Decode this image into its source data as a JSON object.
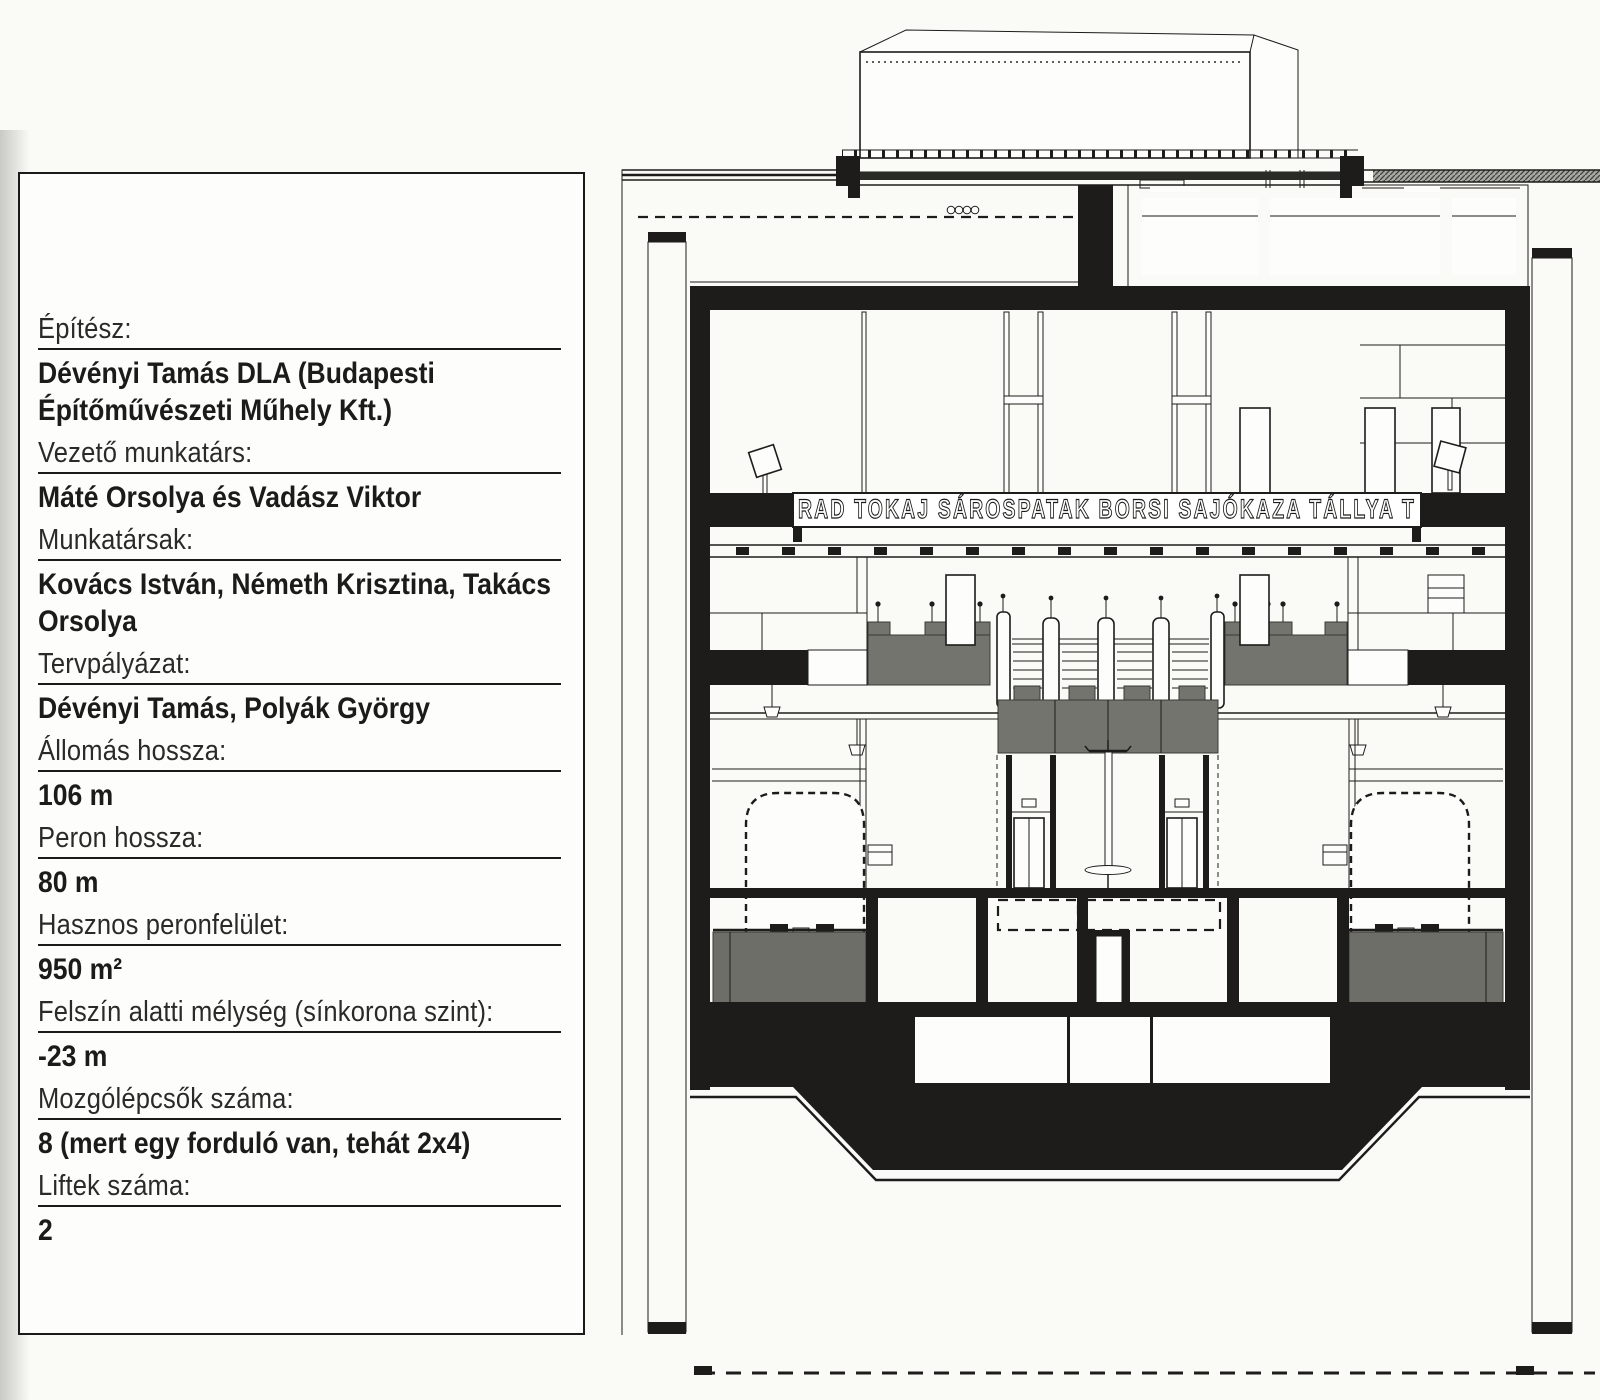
{
  "panel": {
    "fields": [
      {
        "label": "Építész:",
        "value": "Dévényi Tamás DLA (Budapesti Építőművészeti Műhely Kft.)"
      },
      {
        "label": "Vezető munkatárs:",
        "value": "Máté Orsolya és Vadász Viktor"
      },
      {
        "label": "Munkatársak:",
        "value": "Kovács István, Németh Krisztina, Takács Orsolya"
      },
      {
        "label": "Tervpályázat:",
        "value": "Dévényi Tamás, Polyák György"
      },
      {
        "label": "Állomás hossza:",
        "value": "106 m"
      },
      {
        "label": "Peron hossza:",
        "value": "80 m"
      },
      {
        "label": "Hasznos peronfelület:",
        "value": "950 m²"
      },
      {
        "label": "Felszín alatti mélység (sínkorona szint):",
        "value": "-23 m"
      },
      {
        "label": "Mozgólépcsők száma:",
        "value": "8 (mert egy forduló van, tehát 2x4)"
      },
      {
        "label": "Liftek száma:",
        "value": "2"
      }
    ]
  },
  "drawing": {
    "frieze_text": "RAD TOKAJ SÁROSPATAK BORSI SAJÓKAZA TÁLLYA T"
  },
  "colors": {
    "ink": "#1d1c1a",
    "paper": "#fafaf7",
    "gray_fill": "#74746e",
    "hatch_wall": "#b7b7b1"
  }
}
